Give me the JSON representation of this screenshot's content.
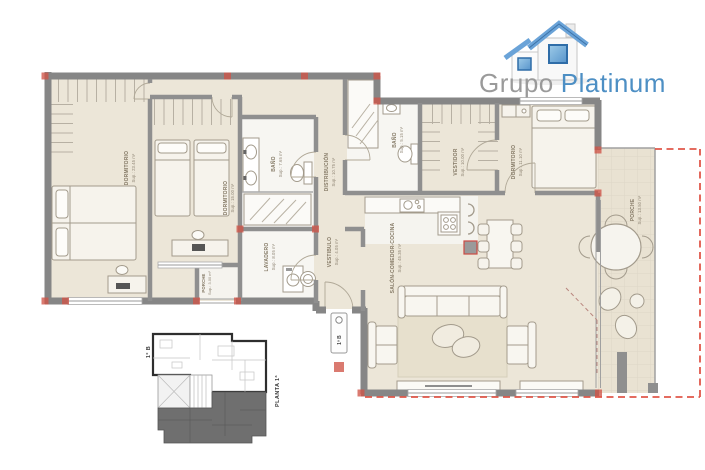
{
  "logo": {
    "brand_gray": "Grupo",
    "brand_blue": "Platinum"
  },
  "rooms": [
    {
      "id": "dormitorio-1",
      "name": "DORMITORIO",
      "area": "Sup.: 23.45 m²"
    },
    {
      "id": "dormitorio-2",
      "name": "DORMITORIO",
      "area": "Sup.: 15.00 m²"
    },
    {
      "id": "bano-1",
      "name": "BAÑO",
      "area": "Sup.: 7.65 m²"
    },
    {
      "id": "distribucion",
      "name": "DISTRIBUCIÓN",
      "area": "Sup.: 10.75 m²"
    },
    {
      "id": "bano-2",
      "name": "BAÑO",
      "area": "Sup.: 5.15 m²"
    },
    {
      "id": "vestidor",
      "name": "VESTIDOR",
      "area": "Sup.: 10.00 m²"
    },
    {
      "id": "dormitorio-3",
      "name": "DORMITORIO",
      "area": "Sup.: 11.10 m²"
    },
    {
      "id": "porche",
      "name": "PORCHE",
      "area": "Sup.: 13.50 m²"
    },
    {
      "id": "salon",
      "name": "SALÓN-COMEDOR-COCINA",
      "area": "Sup.: 45.35 m²"
    },
    {
      "id": "vestibulo",
      "name": "VESTIBULO",
      "area": "Sup.: 4.05 m²"
    },
    {
      "id": "lavadero",
      "name": "LAVADERO",
      "area": "Sup.: 8.05 m²"
    },
    {
      "id": "porche-2",
      "name": "PORCHE",
      "area": "Sup.: 3.00 m²"
    }
  ],
  "unit_plaque": {
    "label": "1º B"
  },
  "key_plan": {
    "unit_label": "1º B",
    "floor_label": "PLANTA 1ª"
  },
  "colors": {
    "wall": "#8a8a8a",
    "floor": "#ece6d8",
    "accent_red": "#d9534f",
    "brand_blue": "#4d8fc4",
    "brand_gray": "#9a9a9a"
  }
}
